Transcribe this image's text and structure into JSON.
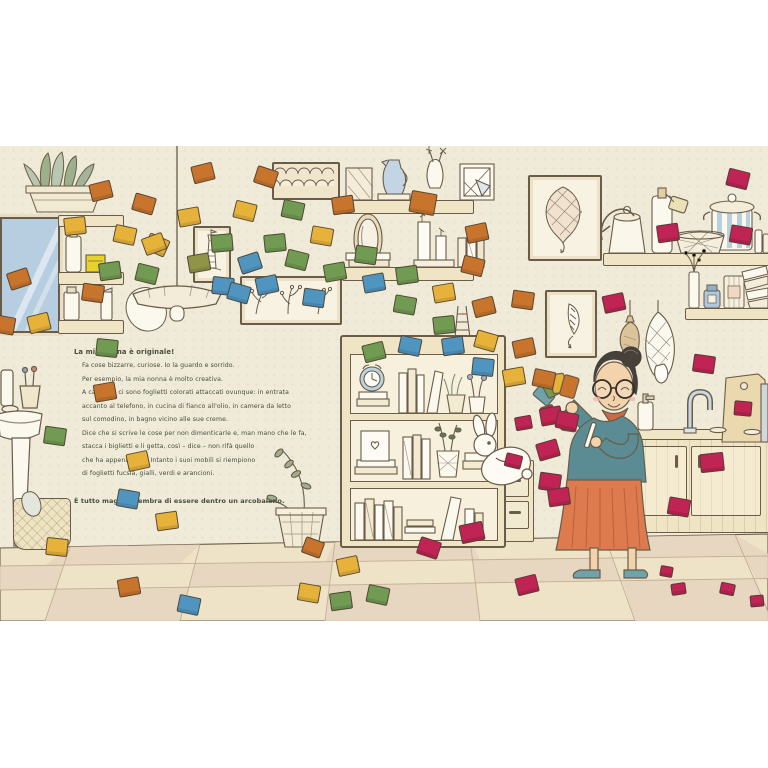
{
  "story": {
    "title": "La mia nonna è originale!",
    "lines": [
      "Fa cose bizzarre, curiose. Io la guardo e sorrido.",
      "Per esempio, la mia nonna è molto creativa.",
      "A casa sua ci sono foglietti colorati attaccati ovunque: in entrata",
      "accanto al telefono, in cucina di fianco all'olio, in camera da letto",
      "sul comodino, in bagno vicino alle sue creme.",
      "Dice che si scrive le cose per non dimenticarle e, man mano che le fa,",
      "stacca i biglietti e li getta,  così – dice – non rifà quello",
      "che ha appena fatto. Intanto i suoi mobili si riempiono",
      "di foglietti fucsia, gialli, verdi e arancioni."
    ],
    "closing": "È tutto magico: sembra di essere dentro un arcobaleno."
  },
  "palette": {
    "wall": "#f0ead8",
    "ink": "#6a5c49",
    "furniture": "#efe4c4",
    "window_blue": "#b7cde0",
    "floor": "#eee3c7",
    "floor_alt": "#e8d5bf",
    "floor_line": "#b7a287",
    "cardigan": "#5b8b93",
    "scarf": "#cf6a40",
    "skirt": "#dd7b4f",
    "skin": "#f2d3ac",
    "hair": "#47413a",
    "shoe": "#6fa3ab",
    "leaf": "#9db08c",
    "text": "#454e3e",
    "note_orange": "#c8742c",
    "note_yellow": "#e6b23a",
    "note_green": "#719a52",
    "note_olive": "#8f9447",
    "note_blue": "#5095c0",
    "note_fuchsia": "#bf2454"
  },
  "scene": {
    "notes": [
      {
        "x": 90,
        "y": 36,
        "c": "orange",
        "r": -14
      },
      {
        "x": 133,
        "y": 49,
        "c": "orange",
        "r": 16
      },
      {
        "x": 64,
        "y": 71,
        "c": "yellow",
        "r": -6
      },
      {
        "x": 114,
        "y": 80,
        "c": "yellow",
        "r": 12
      },
      {
        "x": 146,
        "y": 90,
        "c": "yellow",
        "r": 24
      },
      {
        "x": 8,
        "y": 124,
        "c": "orange",
        "r": -18
      },
      {
        "x": 99,
        "y": 116,
        "c": "green",
        "r": -8
      },
      {
        "x": 136,
        "y": 119,
        "c": "green",
        "r": 14
      },
      {
        "x": 82,
        "y": 138,
        "c": "orange",
        "r": 8
      },
      {
        "x": 28,
        "y": 168,
        "c": "yellow",
        "r": -14
      },
      {
        "x": -7,
        "y": 170,
        "c": "orange",
        "r": 10
      },
      {
        "x": 96,
        "y": 193,
        "c": "green",
        "r": 6
      },
      {
        "x": 94,
        "y": 237,
        "c": "orange",
        "r": -10
      },
      {
        "x": 44,
        "y": 281,
        "c": "green",
        "r": 8
      },
      {
        "x": 127,
        "y": 306,
        "c": "yellow",
        "r": -12
      },
      {
        "x": 117,
        "y": 344,
        "c": "blue",
        "r": 10
      },
      {
        "x": 46,
        "y": 392,
        "c": "yellow",
        "r": 6
      },
      {
        "x": 156,
        "y": 366,
        "c": "yellow",
        "r": -8
      },
      {
        "x": 178,
        "y": 450,
        "c": "blue",
        "r": 12
      },
      {
        "x": 118,
        "y": 432,
        "c": "orange",
        "r": -10
      },
      {
        "x": 192,
        "y": 18,
        "c": "orange",
        "r": -14
      },
      {
        "x": 255,
        "y": 22,
        "c": "orange",
        "r": 18
      },
      {
        "x": 178,
        "y": 62,
        "c": "yellow",
        "r": -10
      },
      {
        "x": 234,
        "y": 56,
        "c": "yellow",
        "r": 14
      },
      {
        "x": 143,
        "y": 89,
        "c": "yellow",
        "r": -20
      },
      {
        "x": 211,
        "y": 88,
        "c": "green",
        "r": -5
      },
      {
        "x": 188,
        "y": 108,
        "c": "olive",
        "r": -10
      },
      {
        "x": 212,
        "y": 131,
        "c": "blue",
        "r": 6
      },
      {
        "x": 256,
        "y": 130,
        "c": "blue",
        "r": -12
      },
      {
        "x": 303,
        "y": 143,
        "c": "blue",
        "r": 8
      },
      {
        "x": 228,
        "y": 138,
        "c": "blue",
        "r": 16
      },
      {
        "x": 311,
        "y": 81,
        "c": "yellow",
        "r": 10
      },
      {
        "x": 332,
        "y": 50,
        "c": "orange",
        "r": -8
      },
      {
        "x": 282,
        "y": 55,
        "c": "green",
        "r": 12
      },
      {
        "x": 264,
        "y": 88,
        "c": "green",
        "r": -6
      },
      {
        "x": 286,
        "y": 105,
        "c": "green",
        "r": 14
      },
      {
        "x": 324,
        "y": 117,
        "c": "green",
        "r": -10
      },
      {
        "x": 239,
        "y": 108,
        "c": "blue",
        "r": -18
      },
      {
        "x": 410,
        "y": 46,
        "c": "orange",
        "r": 10,
        "w": 24,
        "h": 20
      },
      {
        "x": 466,
        "y": 78,
        "c": "orange",
        "r": -12
      },
      {
        "x": 396,
        "y": 120,
        "c": "green",
        "r": -8
      },
      {
        "x": 462,
        "y": 111,
        "c": "orange",
        "r": 14
      },
      {
        "x": 433,
        "y": 138,
        "c": "yellow",
        "r": -10
      },
      {
        "x": 394,
        "y": 150,
        "c": "green",
        "r": 10
      },
      {
        "x": 473,
        "y": 152,
        "c": "orange",
        "r": -14
      },
      {
        "x": 512,
        "y": 145,
        "c": "orange",
        "r": 8
      },
      {
        "x": 433,
        "y": 170,
        "c": "green",
        "r": -6
      },
      {
        "x": 399,
        "y": 191,
        "c": "blue",
        "r": 12
      },
      {
        "x": 442,
        "y": 191,
        "c": "blue",
        "r": -8
      },
      {
        "x": 475,
        "y": 186,
        "c": "yellow",
        "r": 16
      },
      {
        "x": 513,
        "y": 193,
        "c": "orange",
        "r": -12
      },
      {
        "x": 472,
        "y": 212,
        "c": "blue",
        "r": 6
      },
      {
        "x": 503,
        "y": 222,
        "c": "yellow",
        "r": -10
      },
      {
        "x": 533,
        "y": 224,
        "c": "orange",
        "r": 12
      },
      {
        "x": 363,
        "y": 128,
        "c": "blue",
        "r": -10
      },
      {
        "x": 355,
        "y": 100,
        "c": "green",
        "r": 8
      },
      {
        "x": 363,
        "y": 197,
        "c": "green",
        "r": -14
      },
      {
        "x": 727,
        "y": 24,
        "c": "fuchsia",
        "r": 14
      },
      {
        "x": 657,
        "y": 78,
        "c": "fuchsia",
        "r": -8
      },
      {
        "x": 730,
        "y": 80,
        "c": "fuchsia",
        "r": 10
      },
      {
        "x": 603,
        "y": 148,
        "c": "fuchsia",
        "r": -12
      },
      {
        "x": 693,
        "y": 209,
        "c": "fuchsia",
        "r": 8
      },
      {
        "x": 734,
        "y": 255,
        "c": "fuchsia",
        "r": 5,
        "w": 16,
        "h": 13
      },
      {
        "x": 700,
        "y": 307,
        "c": "fuchsia",
        "r": -6,
        "w": 22,
        "h": 17
      },
      {
        "x": 668,
        "y": 352,
        "c": "fuchsia",
        "r": 10
      },
      {
        "x": 540,
        "y": 261,
        "c": "fuchsia",
        "r": -10
      },
      {
        "x": 556,
        "y": 266,
        "c": "fuchsia",
        "r": 12
      },
      {
        "x": 537,
        "y": 295,
        "c": "fuchsia",
        "r": -16
      },
      {
        "x": 539,
        "y": 327,
        "c": "fuchsia",
        "r": 8
      },
      {
        "x": 548,
        "y": 342,
        "c": "fuchsia",
        "r": -8
      },
      {
        "x": 505,
        "y": 308,
        "c": "fuchsia",
        "r": 14,
        "w": 15,
        "h": 12
      },
      {
        "x": 515,
        "y": 270,
        "c": "fuchsia",
        "r": -10,
        "w": 15,
        "h": 12
      },
      {
        "x": 460,
        "y": 377,
        "c": "fuchsia",
        "r": -12,
        "w": 22,
        "h": 17
      },
      {
        "x": 418,
        "y": 393,
        "c": "fuchsia",
        "r": 18
      },
      {
        "x": 516,
        "y": 430,
        "c": "fuchsia",
        "r": -14
      },
      {
        "x": 660,
        "y": 420,
        "c": "fuchsia",
        "r": 10,
        "w": 11,
        "h": 9
      },
      {
        "x": 671,
        "y": 437,
        "c": "fuchsia",
        "r": -8,
        "w": 13,
        "h": 10
      },
      {
        "x": 720,
        "y": 437,
        "c": "fuchsia",
        "r": 12,
        "w": 13,
        "h": 10
      },
      {
        "x": 750,
        "y": 449,
        "c": "fuchsia",
        "r": -5,
        "w": 12,
        "h": 10
      },
      {
        "x": 303,
        "y": 393,
        "c": "orange",
        "r": 20,
        "w": 18,
        "h": 15
      },
      {
        "x": 337,
        "y": 411,
        "c": "yellow",
        "r": -12
      },
      {
        "x": 298,
        "y": 438,
        "c": "yellow",
        "r": 10
      },
      {
        "x": 330,
        "y": 446,
        "c": "green",
        "r": -8
      },
      {
        "x": 367,
        "y": 440,
        "c": "green",
        "r": 12
      }
    ]
  }
}
